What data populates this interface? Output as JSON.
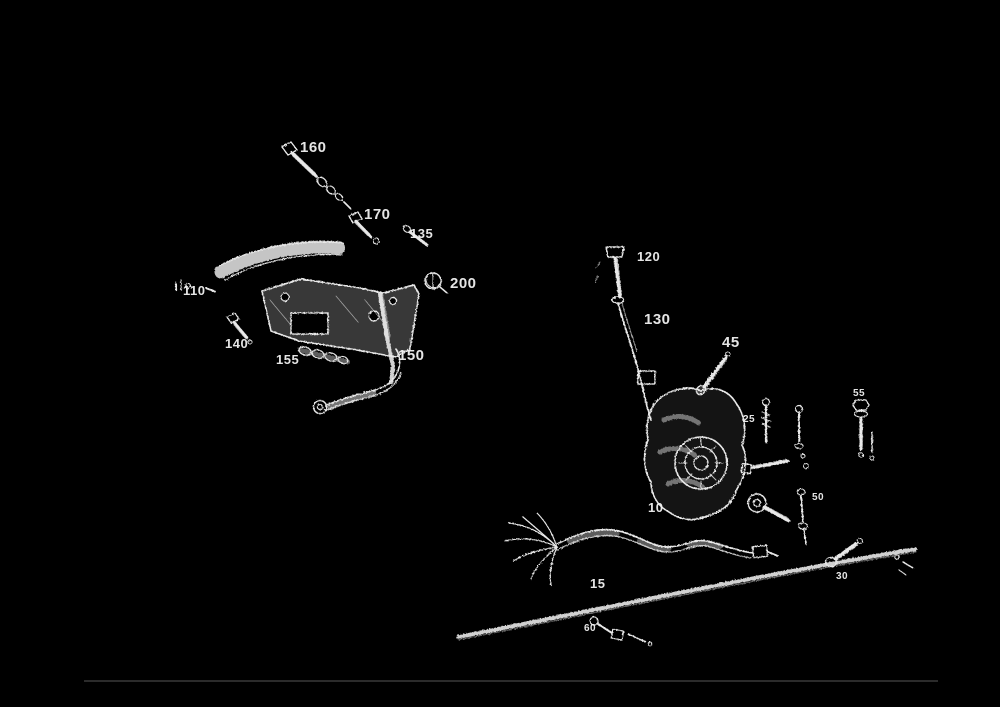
{
  "page": {
    "background_color": "#000000",
    "line_color": "#e8e8e8",
    "divider_color": "#2b2b2b"
  },
  "diagram": {
    "part_labels": {
      "p160": "160",
      "p170": "170",
      "p135": "135",
      "p200": "200",
      "p110": "110",
      "p140": "140",
      "p155": "155",
      "p150": "150",
      "p120": "120",
      "p130": "130",
      "p45": "45",
      "p10": "10",
      "p25": "25",
      "p55": "55",
      "p50": "50",
      "p15": "15",
      "p60": "60",
      "p30": "30"
    }
  }
}
